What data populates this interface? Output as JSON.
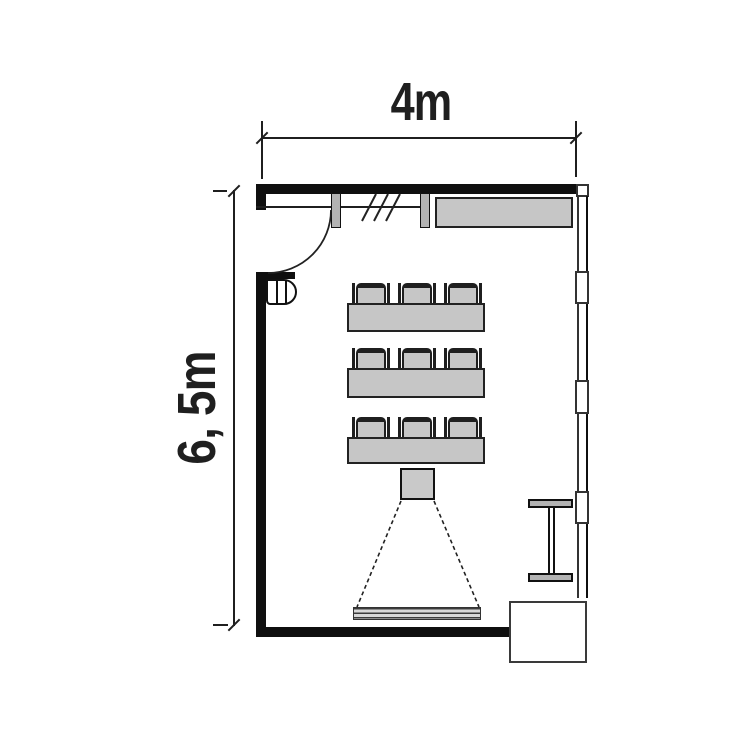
{
  "dimensions": {
    "top": {
      "label": "4m"
    },
    "left": {
      "label": "6, 5m"
    }
  },
  "inventory": {
    "desk_rows": 3,
    "chairs_per_row": 3
  },
  "colors": {
    "line": "#1f1f1f",
    "wall": "#0f0f0f",
    "furniture": "#c6c6c6",
    "fixture": "#b3b3b3",
    "background": "#ffffff"
  }
}
